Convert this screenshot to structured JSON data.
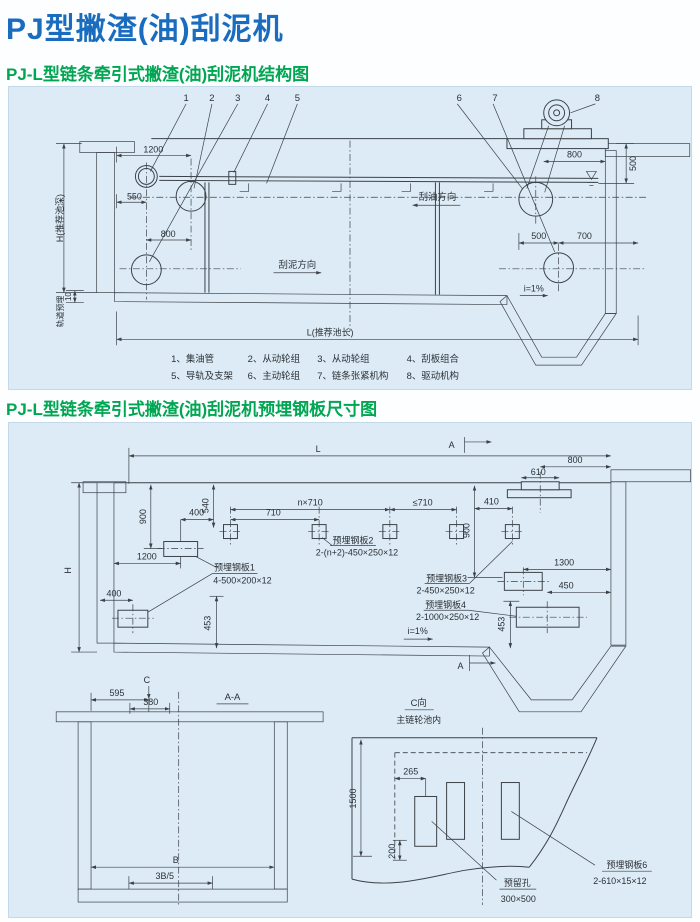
{
  "page": {
    "title": "PJ型撇渣(油)刮泥机"
  },
  "sections": {
    "s1": "PJ-L型链条牵引式撇渣(油)刮泥机结构图",
    "s2": "PJ-L型链条牵引式撇渣(油)刮泥机预埋钢板尺寸图"
  },
  "colors": {
    "title_blue": "#1a6dbe",
    "heading_green": "#00a651",
    "line": "#3b4147",
    "panel_bg": "#dcebf6",
    "panel_border": "#c3d9ea",
    "page_bg": "#fdfeff"
  },
  "d1": {
    "callouts": [
      "1",
      "2",
      "3",
      "4",
      "5",
      "6",
      "7",
      "8"
    ],
    "dims": {
      "w1200": "1200",
      "w550": "550",
      "w800": "800",
      "t800": "800",
      "r500": "500",
      "b500": "500",
      "b700": "700",
      "g10": "10"
    },
    "labels": {
      "depth": "H(推荐池深)",
      "rail": "轨道预埋",
      "oil": "刮油方向",
      "mud": "刮泥方向",
      "slope": "i=1%",
      "length": "L(推荐池长)"
    },
    "legend": {
      "row1": [
        "1、集油管",
        "2、从动轮组",
        "3、从动轮组",
        "4、刮板组合"
      ],
      "row2": [
        "5、导轨及支架",
        "6、主动轮组",
        "7、链条张紧机构",
        "8、驱动机构"
      ]
    }
  },
  "d2": {
    "dims": {
      "L": "L",
      "H": "H",
      "a": "A",
      "v900a": "900",
      "v540": "540",
      "h400a": "400",
      "h1200": "1200",
      "h710": "710",
      "n710": "n×710",
      "le710": "≤710",
      "h410": "410",
      "v900b": "900",
      "h800": "800",
      "h610": "610",
      "h1300": "1300",
      "h450": "450",
      "v453a": "453",
      "v453b": "453",
      "h400b": "400",
      "slope": "i=1%"
    },
    "plates": {
      "p1": {
        "name": "预埋钢板1",
        "spec": "4-500×200×12"
      },
      "p2": {
        "name": "预埋钢板2",
        "spec": "2-(n+2)-450×250×12"
      },
      "p3": {
        "name": "预埋钢板3",
        "spec": "2-450×250×12"
      },
      "p4": {
        "name": "预埋钢板4",
        "spec": "2-1000×250×12"
      }
    }
  },
  "aa": {
    "c": "C",
    "title": "A-A",
    "d595": "595",
    "d380": "380",
    "b": "B",
    "b35": "3B/5"
  },
  "cv": {
    "title": "C向",
    "subtitle": "主链轮池内",
    "d1500": "1500",
    "d265": "265",
    "d200": "200",
    "hole": {
      "name": "预留孔",
      "spec": "300×500"
    },
    "p6": {
      "name": "预埋钢板6",
      "spec": "2-610×15×12"
    }
  }
}
